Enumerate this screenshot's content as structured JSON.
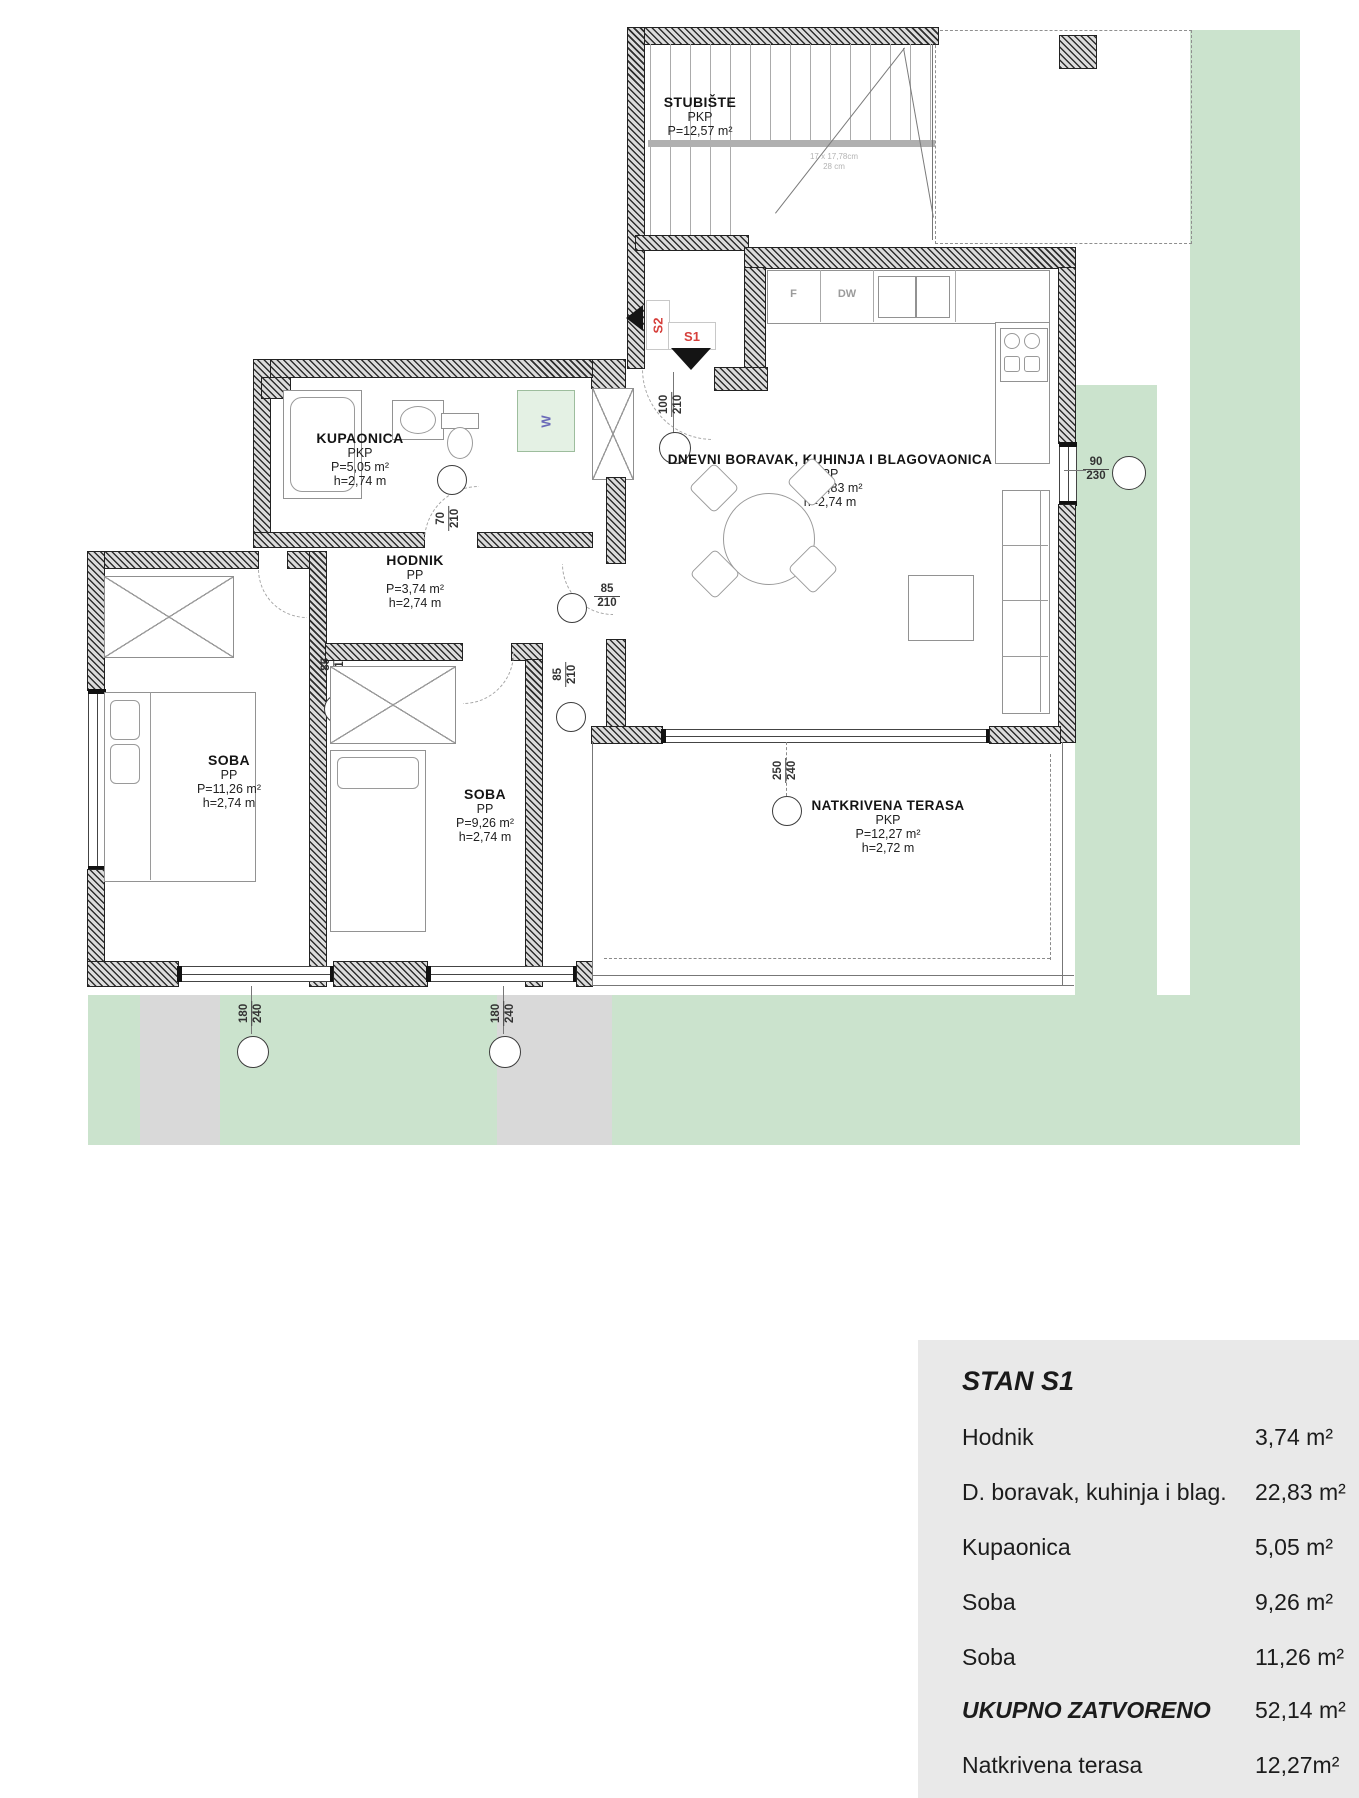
{
  "rooms": {
    "stubiste": {
      "name": "STUBIŠTE",
      "type": "PKP",
      "area": "P=12,57 m²"
    },
    "kupaonica": {
      "name": "KUPAONICA",
      "type": "PKP",
      "area": "P=5,05 m²",
      "height": "h=2,74 m"
    },
    "hodnik": {
      "name": "HODNIK",
      "type": "PP",
      "area": "P=3,74 m²",
      "height": "h=2,74 m"
    },
    "dnevni": {
      "name": "DNEVNI BORAVAK, KUHINJA I BLAGOVAONICA",
      "type": "PP",
      "area": "P=22,83 m²",
      "height": "h=2,74 m"
    },
    "soba_left": {
      "name": "SOBA",
      "type": "PP",
      "area": "P=11,26 m²",
      "height": "h=2,74 m"
    },
    "soba_right": {
      "name": "SOBA",
      "type": "PP",
      "area": "P=9,26 m²",
      "height": "h=2,74 m"
    },
    "terasa": {
      "name": "NATKRIVENA TERASA",
      "type": "PKP",
      "area": "P=12,27 m²",
      "height": "h=2,72 m"
    }
  },
  "markers": {
    "entry": {
      "w": "100",
      "h": "210"
    },
    "bath": {
      "w": "70",
      "h": "210"
    },
    "living_door": {
      "w": "85",
      "h": "210"
    },
    "soba_left": {
      "w": "85",
      "h": "210"
    },
    "soba_right": {
      "w": "85",
      "h": "210"
    },
    "window_living": {
      "w": "90",
      "h": "230"
    },
    "terrace": {
      "w": "250",
      "h": "240"
    },
    "window_left": {
      "w": "180",
      "h": "240"
    },
    "window_right": {
      "w": "180",
      "h": "240"
    }
  },
  "labels": {
    "s1": "S1",
    "s2": "S2",
    "fridge": "F",
    "dishwasher": "DW",
    "washer": "W",
    "stair_note1": "17 x 17,78cm",
    "stair_note2": "28 cm"
  },
  "summary_table": {
    "title": "STAN S1",
    "rows": [
      {
        "label": "Hodnik",
        "value": "3,74 m²"
      },
      {
        "label": "D. boravak, kuhinja i blag.",
        "value": "22,83 m²"
      },
      {
        "label": "Kupaonica",
        "value": "5,05 m²"
      },
      {
        "label": "Soba",
        "value": "9,26 m²"
      },
      {
        "label": "Soba",
        "value": "11,26 m²"
      },
      {
        "label": "UKUPNO ZATVORENO",
        "value": "52,14 m²"
      },
      {
        "label": "Natkrivena terasa",
        "value": "12,27m²"
      }
    ]
  },
  "colors": {
    "lawn": "#cbe3cd",
    "panel": "#e9e9e9",
    "accent_red": "#d6403c",
    "washer_green": "#e4f1e4"
  }
}
